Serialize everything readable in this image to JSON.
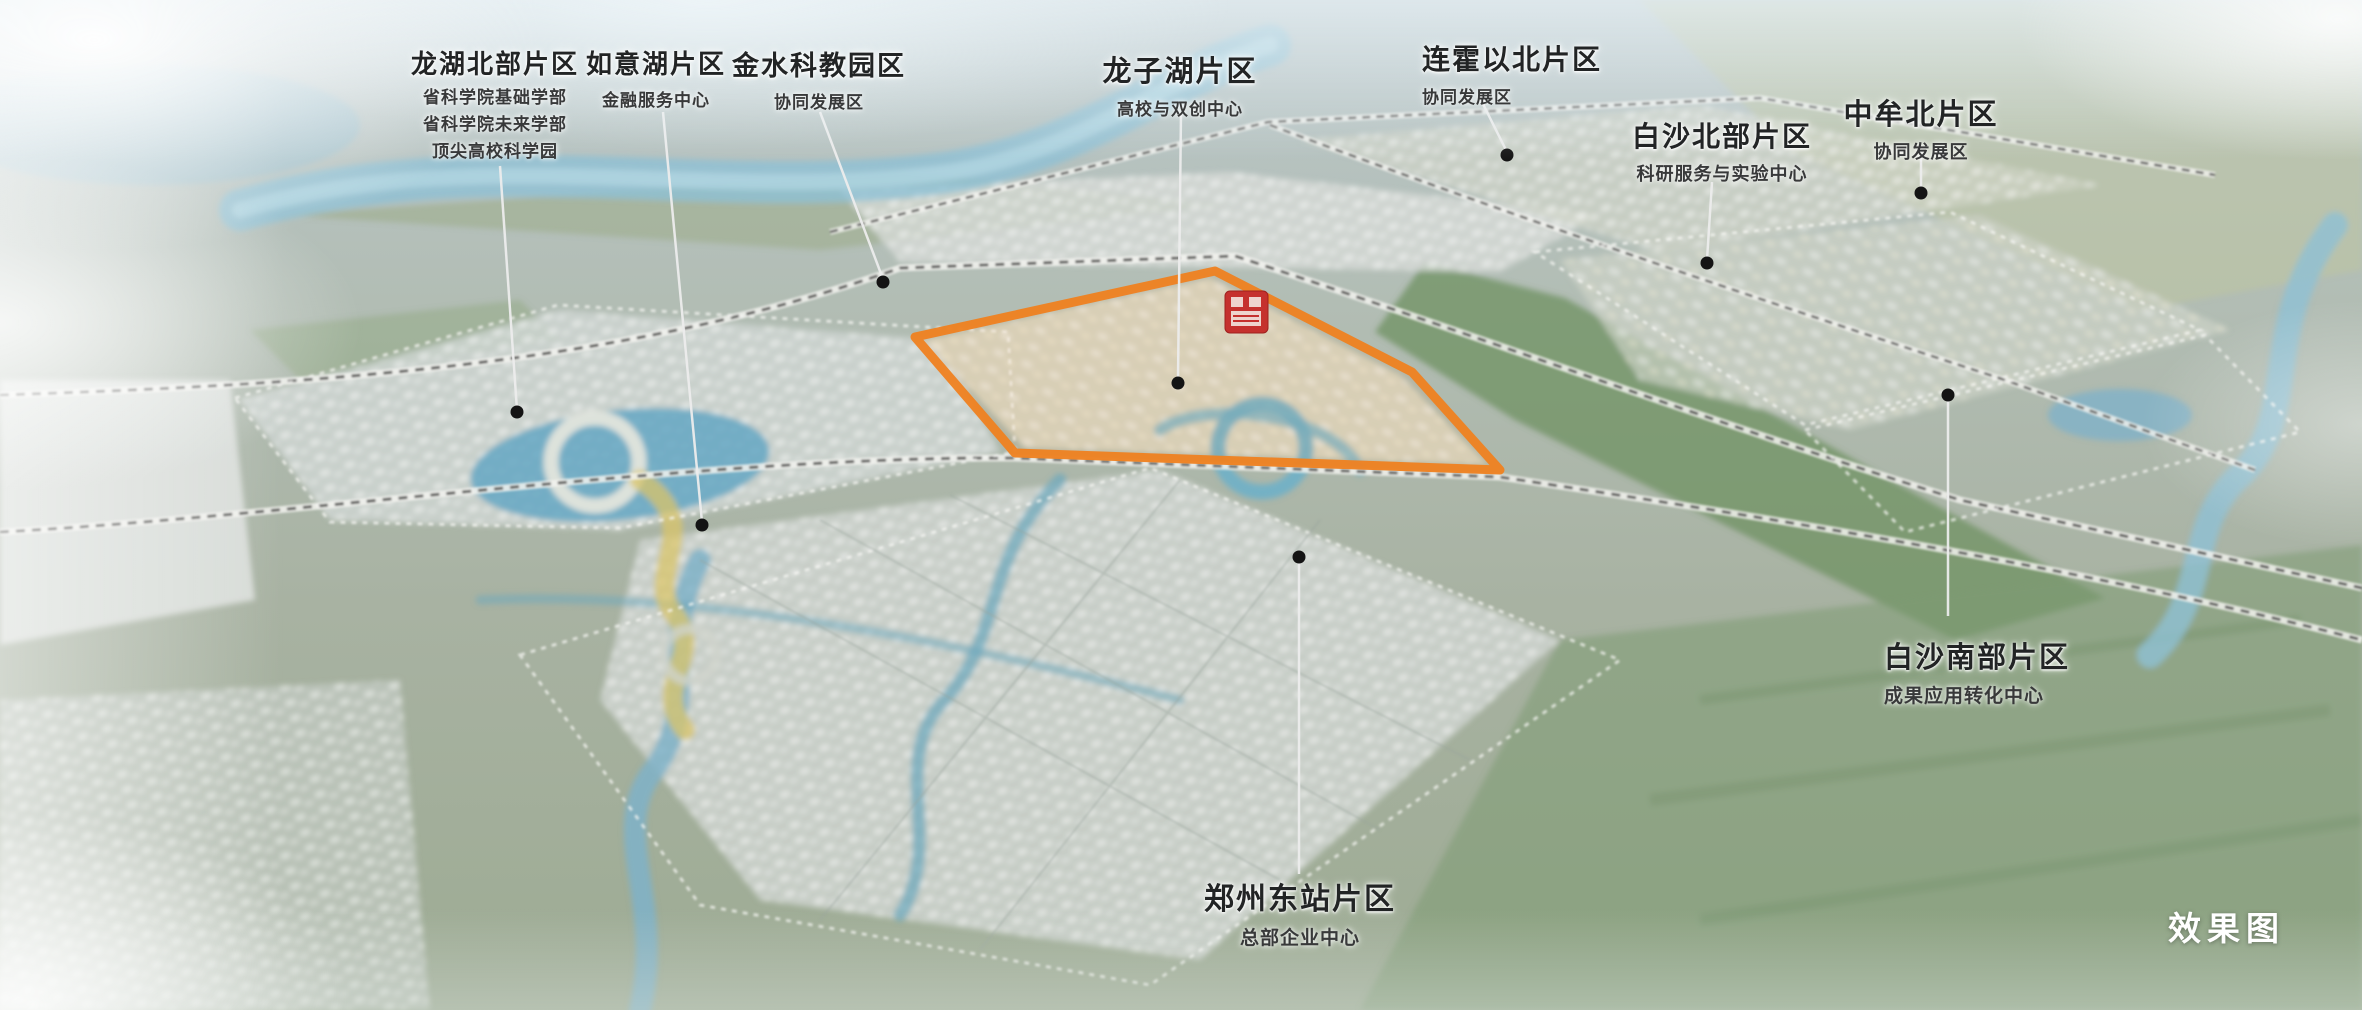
{
  "map": {
    "caption": "效果图",
    "highlight_color": "#EF8120",
    "badge_color": "#C5312E",
    "leader_dot_color": "#141414"
  },
  "districts": [
    {
      "name": "龙湖北部片区",
      "subtitles": [
        "省科学院基础学部",
        "省科学院未来学部",
        "顶尖高校科学园"
      ]
    },
    {
      "name": "如意湖片区",
      "subtitles": [
        "金融服务中心"
      ]
    },
    {
      "name": "金水科教园区",
      "subtitles": [
        "协同发展区"
      ]
    },
    {
      "name": "龙子湖片区",
      "subtitles": [
        "高校与双创中心"
      ]
    },
    {
      "name": "连霍以北片区",
      "subtitles": [
        "协同发展区"
      ]
    },
    {
      "name": "白沙北部片区",
      "subtitles": [
        "科研服务与实验中心"
      ]
    },
    {
      "name": "中牟北片区",
      "subtitles": [
        "协同发展区"
      ]
    },
    {
      "name": "白沙南部片区",
      "subtitles": [
        "成果应用转化中心"
      ]
    },
    {
      "name": "郑州东站片区",
      "subtitles": [
        "总部企业中心"
      ]
    }
  ]
}
